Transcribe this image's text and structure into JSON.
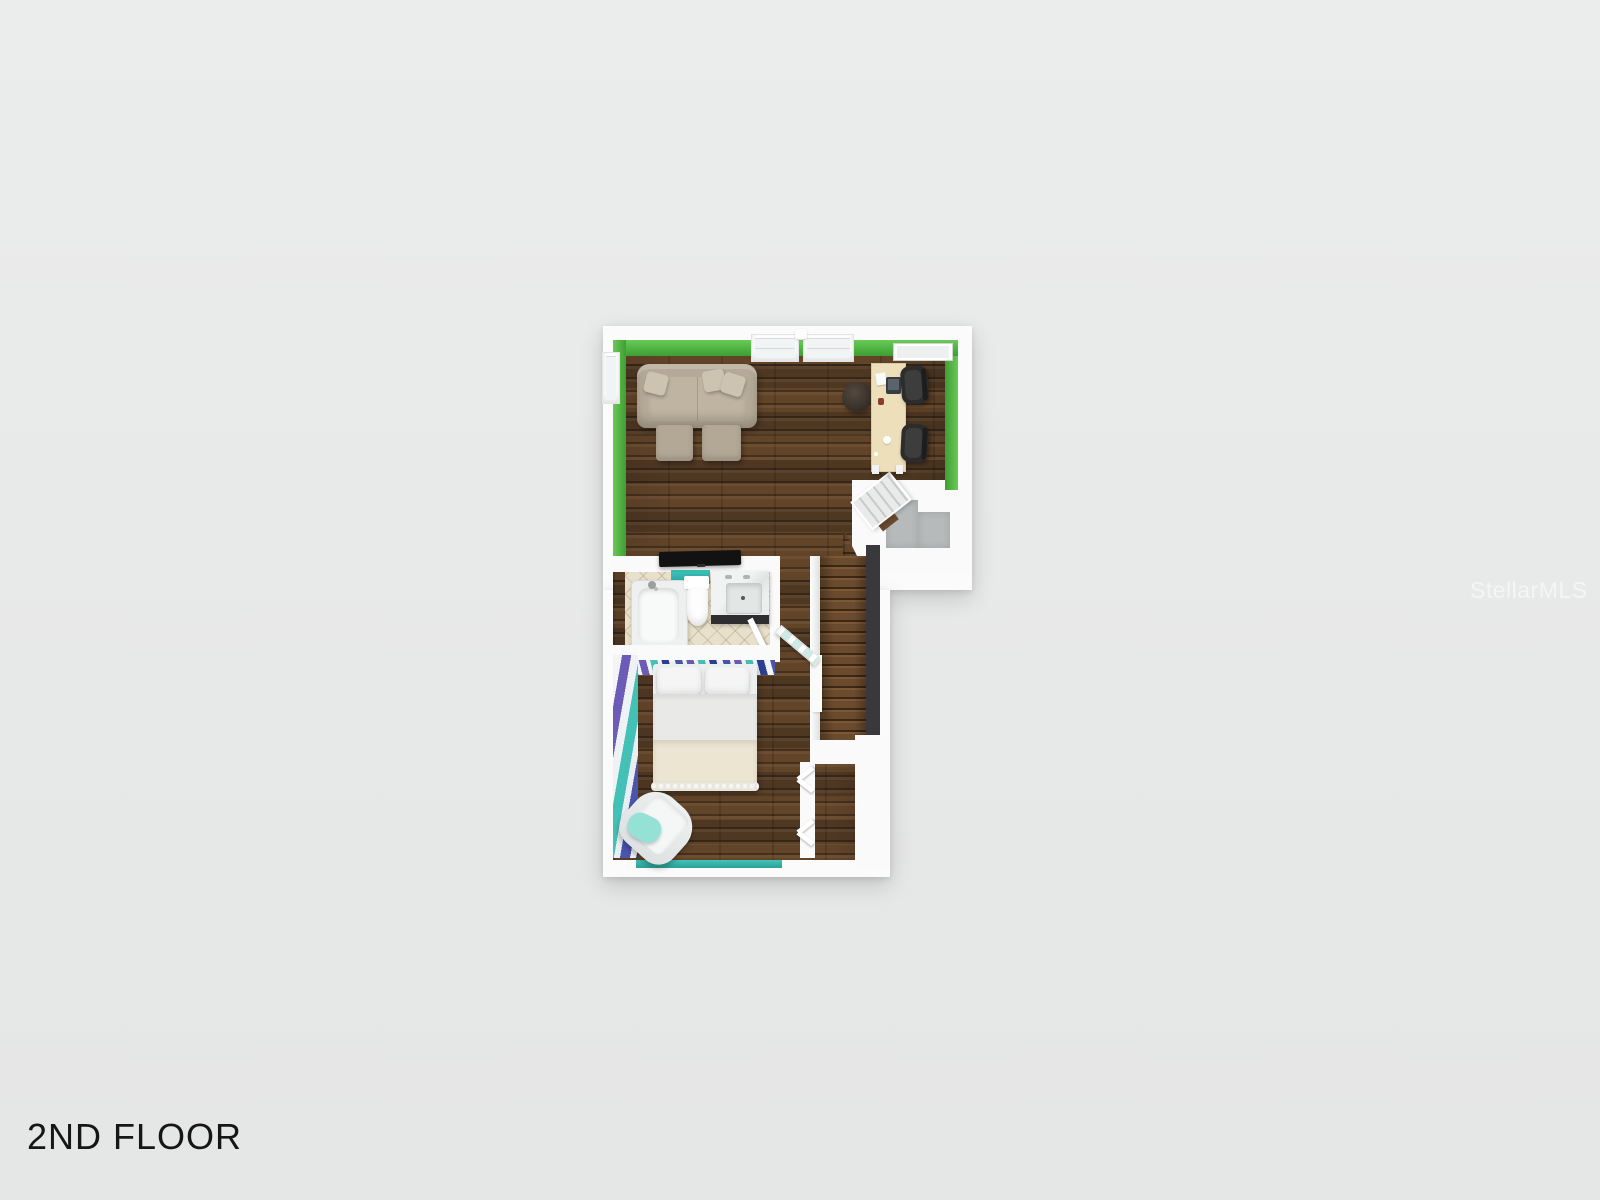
{
  "page": {
    "floor_label": "2ND FLOOR",
    "watermark": "StellarMLS",
    "background_color": "#e8e9e9"
  },
  "floorplan": {
    "view": "3D top-down render of second storey",
    "colors": {
      "wall_white": "#fafafa",
      "accent_green": "#52b746",
      "accent_teal": "#33b7ad",
      "wood_floor": "#5a412a",
      "stair_wood": "#6b4b2d",
      "tile_beige": "#e8e0ca",
      "rug_gray": "#b7baba",
      "stair_side_wall_dark": "#39383a",
      "stripe_navy": "#4a55ae",
      "stripe_purple": "#6c5cb8",
      "stripe_teal": "#44c1b6",
      "stripe_white": "#f2f4f6"
    },
    "rooms": [
      {
        "name": "living-area",
        "walls": "green accent",
        "floor": "dark hardwood planks",
        "furniture": [
          "sectional sofa with three throw pillows",
          "two square ottomans",
          "round dark pouf",
          "cream desk with monitor, papers, mug",
          "two black office chairs",
          "black tv console"
        ],
        "features": [
          "double window top wall",
          "side window left wall",
          "white wall panel top right"
        ]
      },
      {
        "name": "bathroom",
        "walls": "teal accent strip",
        "floor": "beige diagonal tile",
        "fixtures": [
          "bathtub with shower head",
          "toilet",
          "marble vanity with sink and two faucets",
          "swing door"
        ]
      },
      {
        "name": "bedroom",
        "walls": "blue, purple and teal striped accent walls, teal bottom wall",
        "floor": "dark hardwood planks",
        "furniture": [
          "double bed with two pillows, white duvet and cream blanket with ruffle edge",
          "white rounded armchair with mint pillow"
        ],
        "features": [
          "glass swing entry door",
          "two bifold closet doors"
        ]
      },
      {
        "name": "stair-landing",
        "floor": "white with gray area rug and corner steps"
      },
      {
        "name": "staircase",
        "features": [
          "wood treads",
          "white railing left",
          "dark side wall right"
        ]
      },
      {
        "name": "closet",
        "floor": "dark hardwood"
      }
    ]
  }
}
